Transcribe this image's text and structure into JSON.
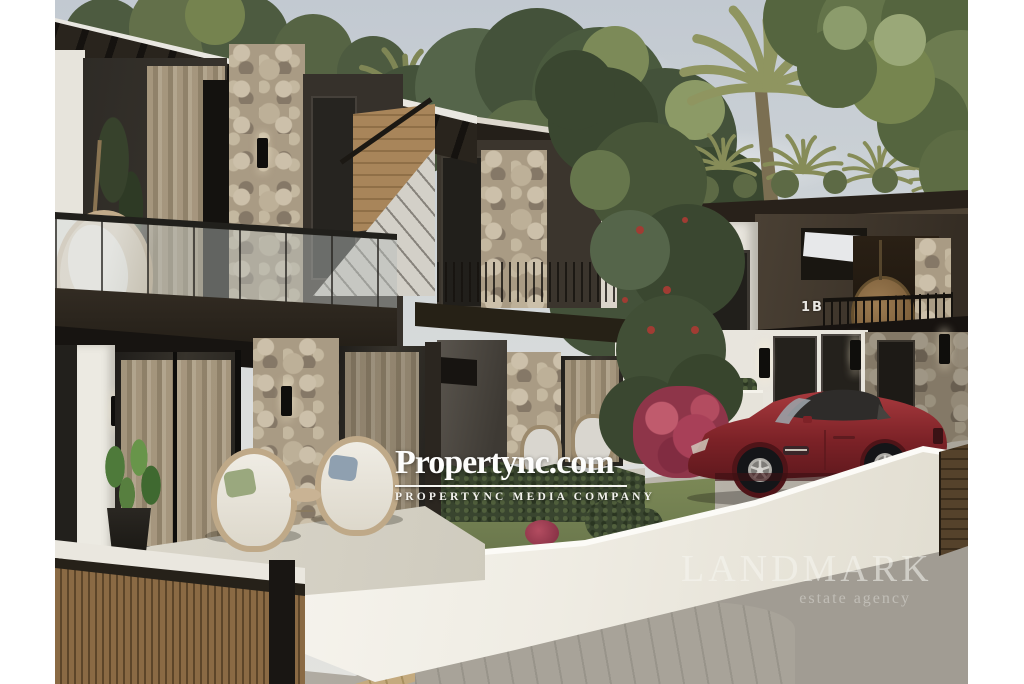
{
  "image": {
    "description": "Architectural 3D rendering of modern two-storey villas with dark facades, stone columns and glass balustrades; palm trees behind, a dark-red convertible sports car parked behind a sweeping white boundary wall, wooden slatted gate at lower left",
    "kind": "real-estate-listing-photo"
  },
  "watermark": {
    "brand": "Propertync.com",
    "tagline": "PROPERTYNC MEDIA COMPANY"
  },
  "agency": {
    "name": "LANDMARK",
    "subtitle": "estate agency"
  },
  "labels": {
    "villa_number": "1B"
  },
  "colors": {
    "sky_top": "#c3cbd3",
    "sky_bottom": "#e2e2de",
    "dark_facade": "#36312a",
    "taupe_facade": "#463c30",
    "white_wall": "#f2efe8",
    "stone": "#a99b84",
    "wood": "#a8855a",
    "foliage_dark": "#44523a",
    "palm": "#8f9560",
    "car_red": "#8e262b",
    "street": "#aaa59c",
    "flowers_pink": "#a84058",
    "watermark_white": "#fdfdfc"
  }
}
